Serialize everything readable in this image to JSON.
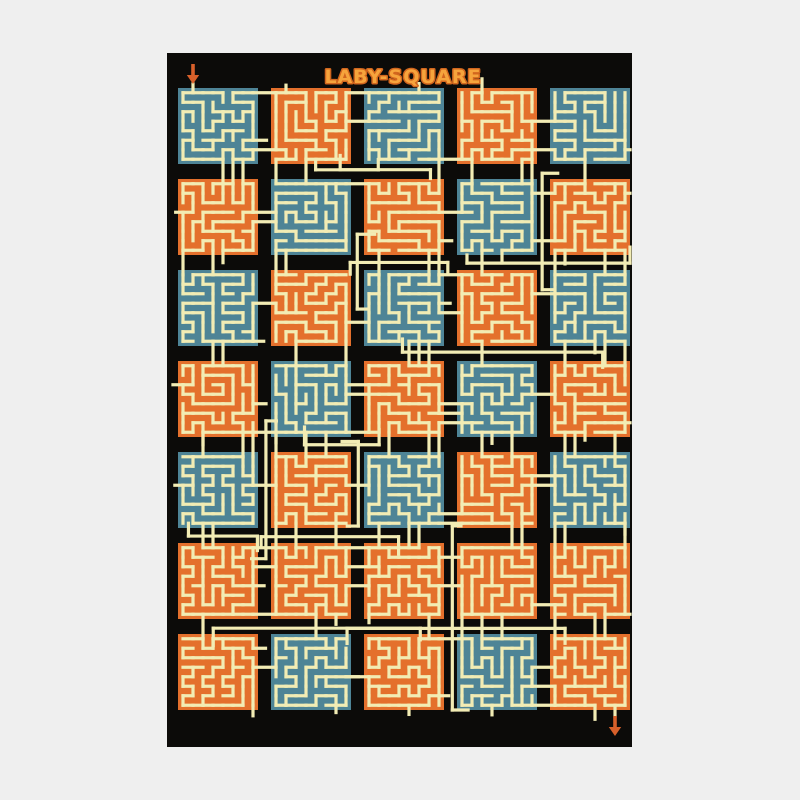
{
  "title": "LABY-SQUARE",
  "page": {
    "background": "#efefef"
  },
  "poster": {
    "background": "#0c0b09",
    "x": 167,
    "y": 53,
    "width": 465,
    "height": 694
  },
  "colors": {
    "teal": "#4e8496",
    "orange": "#e4702c",
    "cream": "#f2ecb4",
    "title_fill": "#f6a43c",
    "title_outline": "#d2661e",
    "arrow": "#d8602a"
  },
  "maze": {
    "grid_cols": 5,
    "grid_rows": 7,
    "cells_per_tile": 8,
    "seed": 97,
    "tile_colors": [
      [
        "teal",
        "orange",
        "teal",
        "orange",
        "teal"
      ],
      [
        "orange",
        "teal",
        "orange",
        "teal",
        "orange"
      ],
      [
        "teal",
        "orange",
        "teal",
        "orange",
        "teal"
      ],
      [
        "orange",
        "teal",
        "orange",
        "teal",
        "orange"
      ],
      [
        "teal",
        "orange",
        "teal",
        "orange",
        "teal"
      ],
      [
        "orange",
        "orange",
        "orange",
        "orange",
        "orange"
      ],
      [
        "orange",
        "teal",
        "orange",
        "teal",
        "orange"
      ]
    ]
  },
  "arrows": {
    "entry": "down-arrow",
    "exit": "down-arrow"
  }
}
